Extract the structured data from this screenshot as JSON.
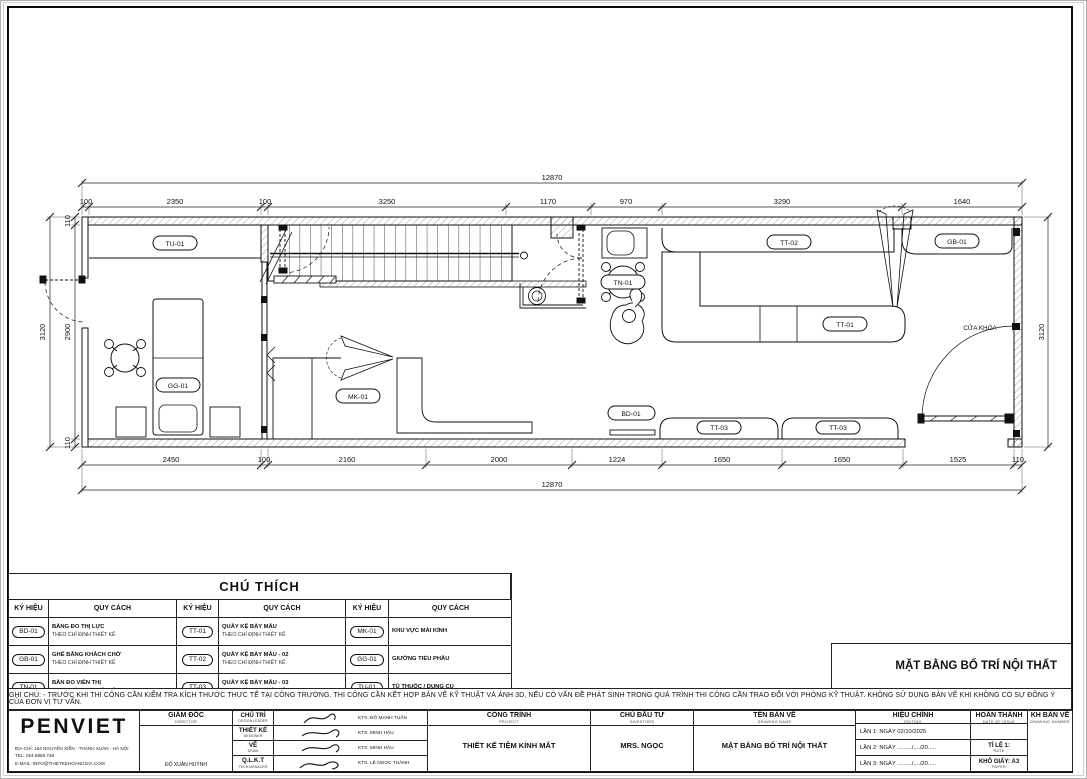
{
  "plan": {
    "dims": {
      "overall": "12870",
      "top": [
        "100",
        "2350",
        "100",
        "3250",
        "1170",
        "970",
        "3290",
        "1640"
      ],
      "bottom": [
        "2450",
        "100",
        "2160",
        "2000",
        "1224",
        "1650",
        "1650",
        "1525",
        "110"
      ],
      "left": [
        "110",
        "2900",
        "110"
      ],
      "side": "3120"
    },
    "labels": {
      "tu01": "TU-01",
      "gg01": "GG-01",
      "mk01": "MK-01",
      "tn01": "TN-01",
      "bd01": "BD-01",
      "tt01": "TT-01",
      "tt02": "TT-02",
      "tt03": "TT-03",
      "gb01": "GB-01",
      "cua_khoa": "CỬA KHÓA"
    }
  },
  "legend": {
    "title": "CHÚ THÍCH",
    "col_symbol": "KÝ HIỆU",
    "col_spec": "QUY CÁCH",
    "rows": [
      [
        {
          "code": "BD-01",
          "name": "BẢNG ĐO THỊ LỰC",
          "note": "THEO CHỈ ĐỊNH THIẾT KẾ"
        },
        {
          "code": "TT-01",
          "name": "QUẦY KỆ BÀY MẪU",
          "note": "THEO CHỈ ĐỊNH THIẾT KẾ"
        },
        {
          "code": "MK-01",
          "name": "KHU VỰC MÀI KÍNH",
          "note": ""
        }
      ],
      [
        {
          "code": "GB-01",
          "name": "GHẾ BĂNG KHÁCH CHỜ",
          "note": "THEO CHỈ ĐỊNH THIẾT KẾ"
        },
        {
          "code": "TT-02",
          "name": "QUẦY KỆ BÀY MẪU - 02",
          "note": "THEO CHỈ ĐỊNH THIẾT KẾ"
        },
        {
          "code": "GG-01",
          "name": "GIƯỜNG TIỂU PHẪU",
          "note": ""
        }
      ],
      [
        {
          "code": "TN-01",
          "name": "BÀN ĐO VIỄN THỊ",
          "note": "THEO CHỈ ĐỊNH THIẾT KẾ"
        },
        {
          "code": "TT-03",
          "name": "QUẦY KỆ BÀY MẪU - 03",
          "note": "THEO CHỈ ĐỊNH THIẾT KẾ"
        },
        {
          "code": "TU-01",
          "name": "TỦ THUỐC / DỤNG CỤ",
          "note": ""
        }
      ]
    ]
  },
  "note": {
    "text": "GHI CHÚ: - TRƯỚC KHI THI CÔNG CẦN KIỂM TRA KÍCH THƯỚC THỰC TẾ TẠI CÔNG TRƯỜNG.  THI CÔNG CẦN KẾT HỢP BẢN VẼ KỸ THUẬT VÀ ẢNH 3D, NẾU CÓ VẤN ĐỀ PHÁT SINH TRONG QUÁ TRÌNH THI CÔNG CẦN TRAO ĐỔI VỚI PHÒNG KỸ THUẬT. KHÔNG SỬ DỤNG BẢN VẼ KHI KHÔNG CÓ SỰ ĐỒNG Ý CỦA ĐƠN VỊ TƯ VẤN."
  },
  "title_block": {
    "drawing_title": "MẶT BẰNG BỐ TRÍ NỘI THẤT",
    "company": {
      "name": "PENVIET",
      "address": "ĐỊA CHỈ:  164 NGUYỄN XIỂN - THANH XUÂN - HÀ NỘI",
      "tel": "TEL:         024.6865.748",
      "email": "E-MAIL:   INFO@THIETKEHOANGGIA.COM"
    },
    "director": {
      "label": "GIÁM ĐỐC",
      "sub": "DIRECTOR",
      "name": "ĐỖ XUÂN HUỲNH"
    },
    "roles": [
      {
        "label": "CHỦ TRÌ",
        "sub": "DESIGN LEADER",
        "name": "KTS. ĐỖ MẠNH TUẤN"
      },
      {
        "label": "THIẾT KẾ",
        "sub": "DESIGNER",
        "name": "KTS. MINH HẬU"
      },
      {
        "label": "VẼ",
        "sub": "DRAW",
        "name": "KTS. MINH HẬU"
      },
      {
        "label": "Q.L.K.T",
        "sub": "TECH.MANAGER",
        "name": "KTS. LÊ NGỌC THÀNH"
      }
    ],
    "project": {
      "label": "CÔNG TRÌNH",
      "sub": "PROJECT",
      "value": "THIẾT KẾ TIỆM KÍNH MẮT"
    },
    "investor": {
      "label": "CHỦ ĐẦU TƯ",
      "sub": "INVESTORS",
      "value": "MRS. NGỌC"
    },
    "drawing_name": {
      "label": "TÊN BẢN VẼ",
      "sub": "DRAWING NAME",
      "value": "MẶT BẰNG BỐ TRÍ NỘI THẤT"
    },
    "editing": {
      "label": "HIỆU CHỈNH",
      "sub": "EDITING",
      "rows": [
        "LẦN 1: NGÀY 02/10/2025",
        "LẦN 2: NGÀY  ........./..../20.....",
        "LẦN 3: NGÀY ........./..../20....."
      ]
    },
    "issue": {
      "label": "HOÀN THÀNH",
      "sub": "DATE OF ISSUE",
      "scale_label": "TỈ LỆ 1:",
      "scale_sub": "RATE",
      "paper_label": "KHỔ GIẤY: A3",
      "paper_sub": "PAPER"
    },
    "number": {
      "label": "KH BẢN VẼ",
      "sub": "DRAWING NUMBER"
    }
  }
}
